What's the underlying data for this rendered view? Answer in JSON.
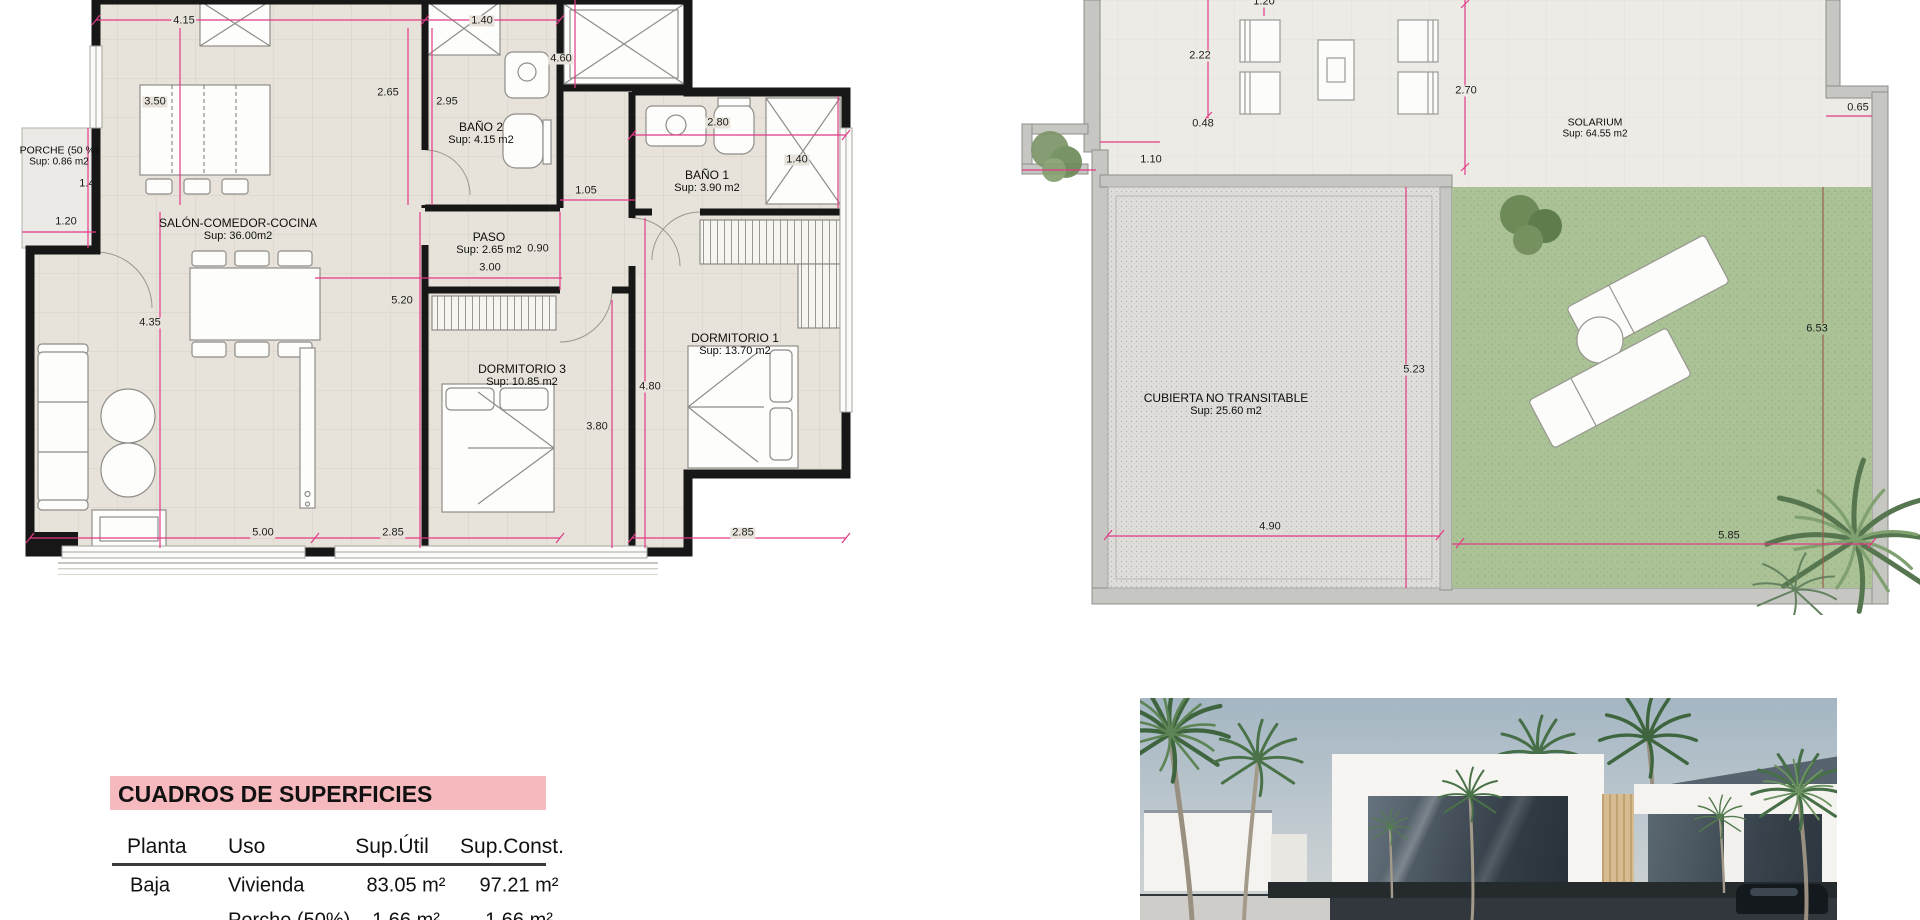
{
  "left_plan": {
    "rooms": {
      "porche": {
        "name": "PORCHE (50 %)",
        "sup": "Sup: 0.86 m2"
      },
      "salon": {
        "name": "SALÓN-COMEDOR-COCINA",
        "sup": "Sup: 36.00m2"
      },
      "bano2": {
        "name": "BAÑO 2",
        "sup": "Sup: 4.15 m2"
      },
      "bano1": {
        "name": "BAÑO 1",
        "sup": "Sup: 3.90 m2"
      },
      "paso": {
        "name": "PASO",
        "sup": "Sup: 2.65 m2"
      },
      "dorm3": {
        "name": "DORMITORIO 3",
        "sup": "Sup: 10.85 m2"
      },
      "dorm1": {
        "name": "DORMITORIO 1",
        "sup": "Sup: 13.70 m2"
      }
    },
    "dims": {
      "w_salon": "4.15",
      "w_bano2": "1.40",
      "h_right_top": "4.60",
      "h_kitchen": "3.50",
      "w_hall": "2.65",
      "h_bano2": "2.95",
      "w_bano1": "2.80",
      "h_bano1_win": "1.40",
      "h_porche": "1.45",
      "w_porche": "1.20",
      "w_pass": "1.05",
      "h_paso": "0.90",
      "w_paso": "3.00",
      "h_dorm3_wall": "5.20",
      "h_salon": "4.35",
      "h_dorm1": "4.80",
      "h_dorm3": "3.80",
      "w_salon_bottom": "5.00",
      "w_dorm3_bottom": "2.85",
      "w_dorm1_bottom": "2.85"
    }
  },
  "right_plan": {
    "rooms": {
      "solarium": {
        "name": "SOLARIUM",
        "sup": "Sup: 64.55 m2"
      },
      "cubierta": {
        "name": "CUBIERTA NO TRANSITABLE",
        "sup": "Sup: 25.60 m2"
      }
    },
    "dims": {
      "top": "1.20",
      "left_terrace": "2.22",
      "step": "0.48",
      "porch_step": "1.10",
      "terrace_h": "2.70",
      "notch": "0.65",
      "cubierta_h": "5.23",
      "lawn_h": "6.53",
      "cubierta_w": "4.90",
      "lawn_w": "5.85"
    }
  },
  "table": {
    "title": "CUADROS DE SUPERFICIES",
    "headers": [
      "Planta",
      "Uso",
      "Sup.Útil",
      "Sup.Const."
    ],
    "rows": [
      {
        "planta": "Baja",
        "uso": "Vivienda",
        "util": "83.05 m²",
        "const": "97.21 m²"
      },
      {
        "planta": "",
        "uso": "Porche (50%)",
        "util": "1.66 m²",
        "const": "1.66 m²"
      }
    ]
  },
  "colors": {
    "dim_line": "#e23a86",
    "wall": "#171717",
    "lawn": "#aac295",
    "table_header_bg": "#f5b9be",
    "floor_left": "#e7e3da",
    "floor_right": "#edebe6"
  }
}
